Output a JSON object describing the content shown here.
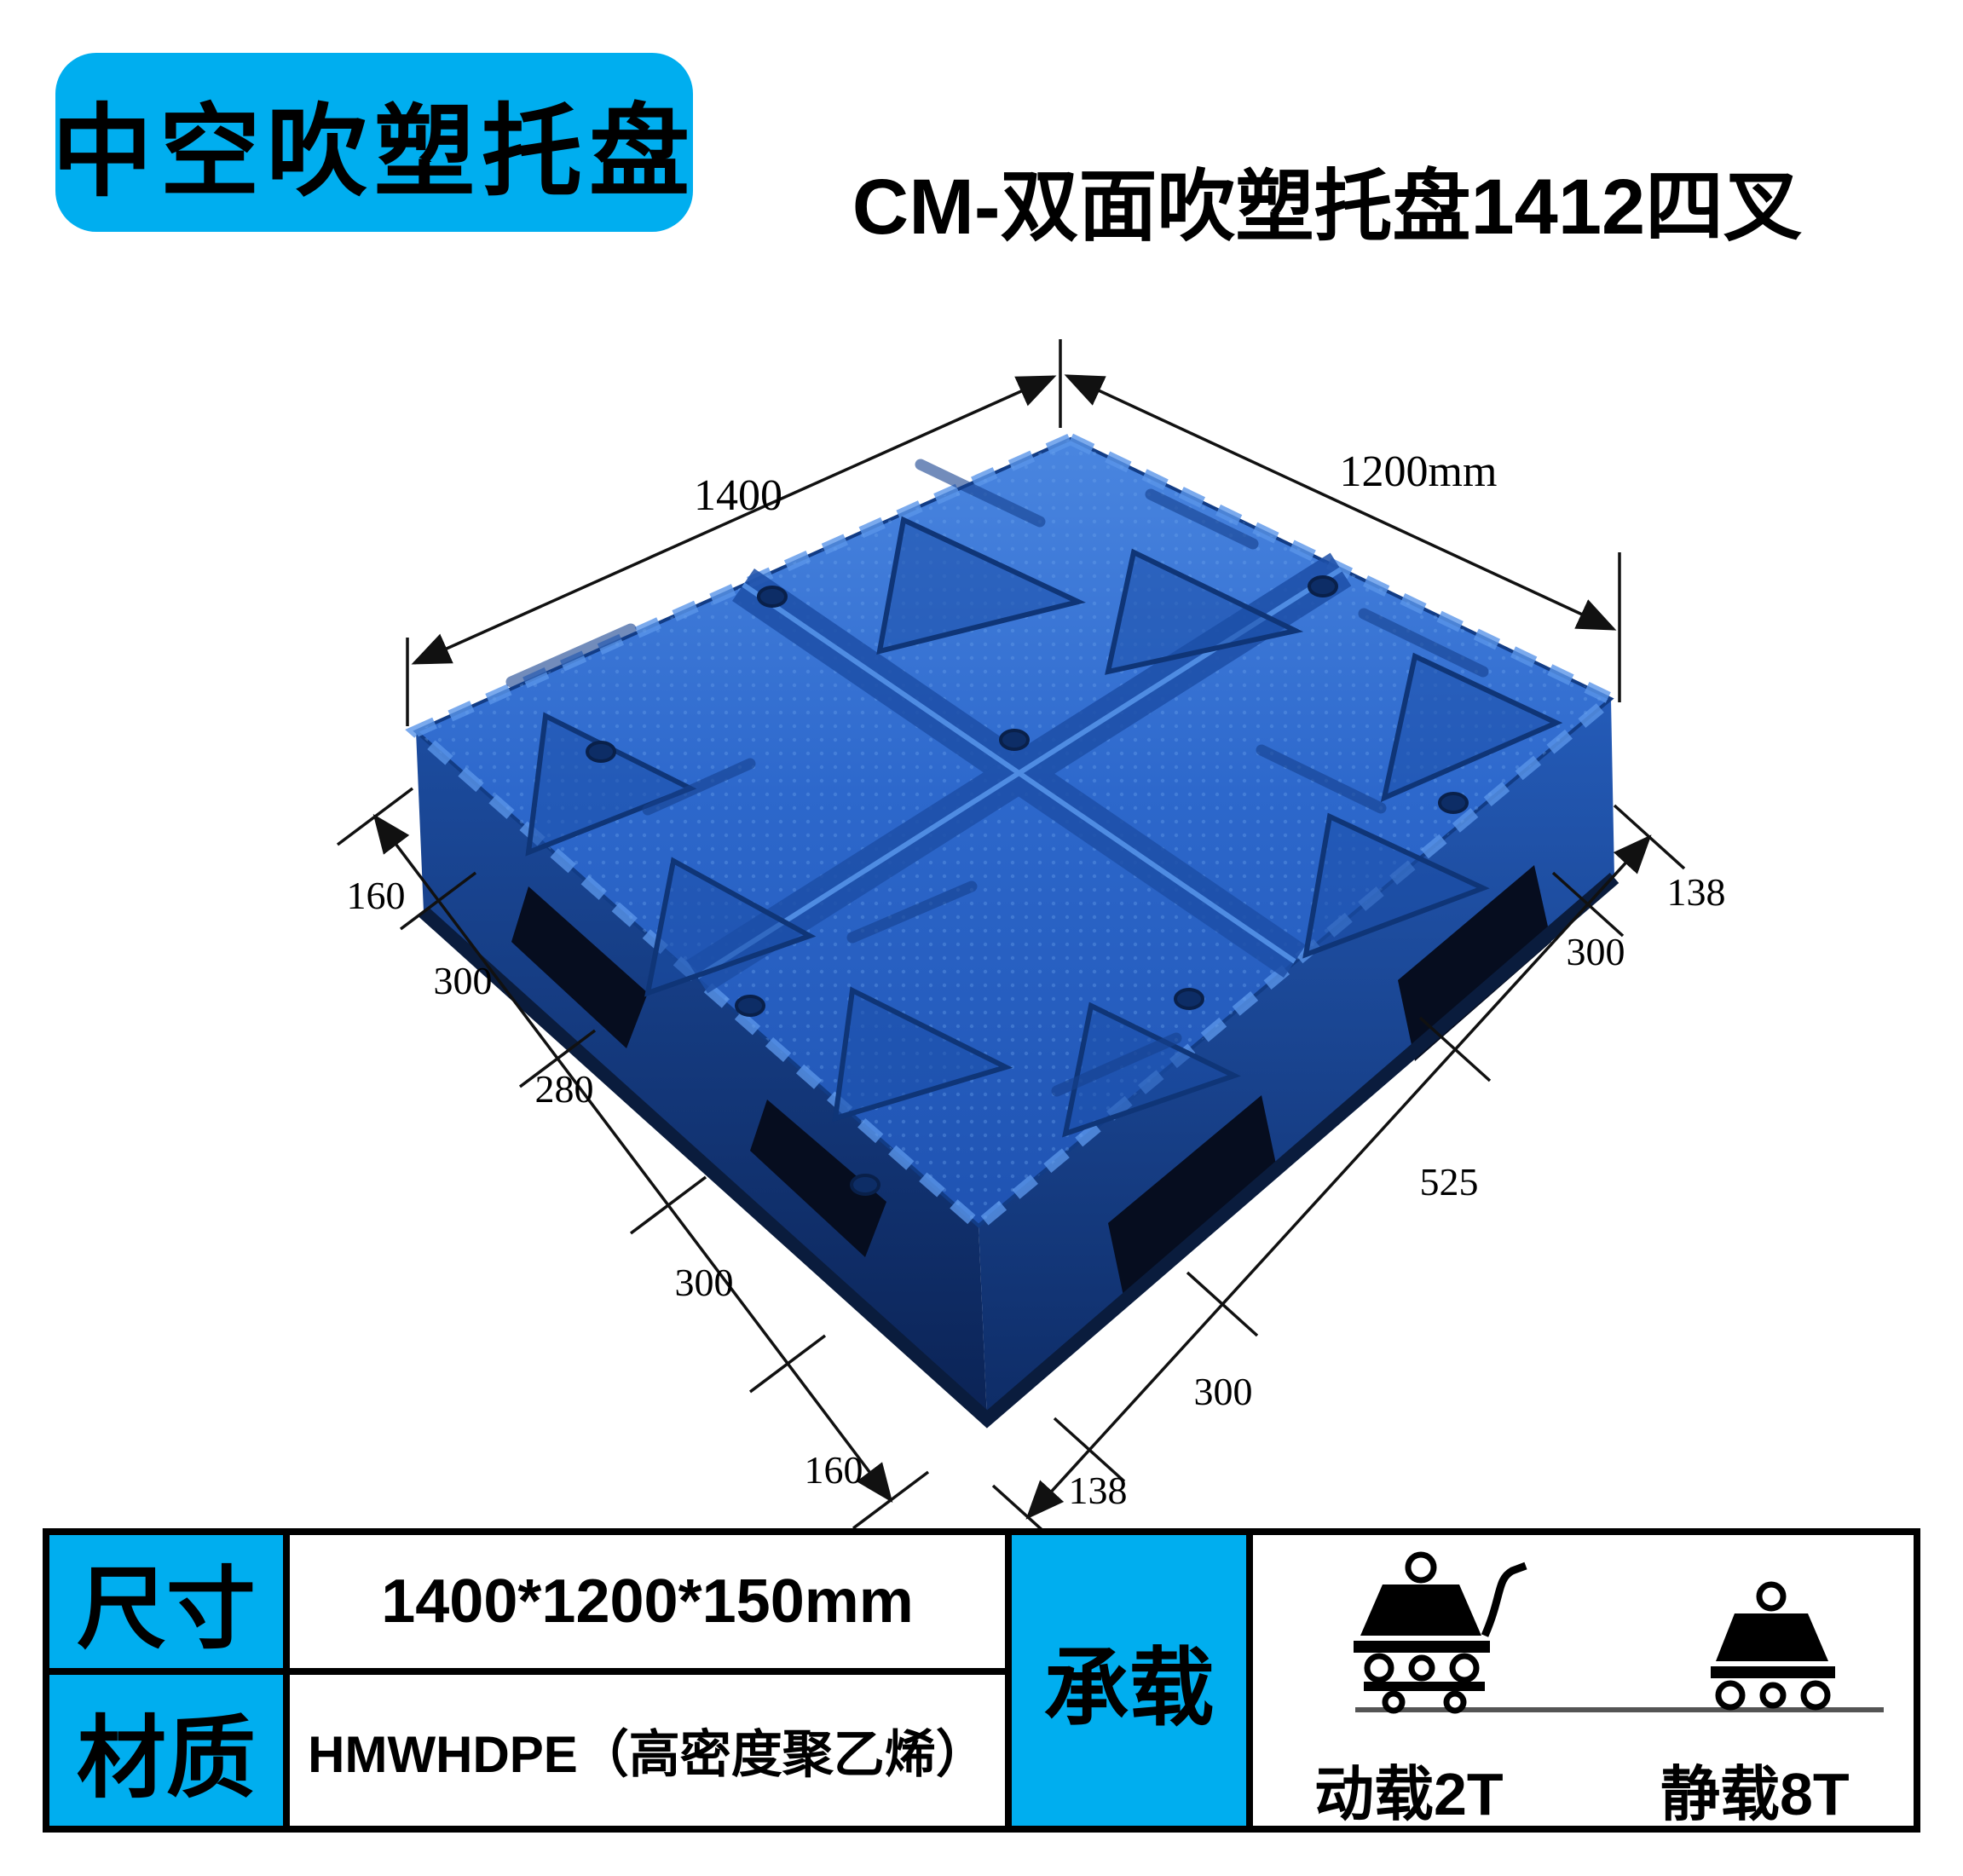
{
  "badge": {
    "label": "中空吹塑托盘"
  },
  "title": {
    "text": "CM-双面吹塑托盘1412四叉"
  },
  "diagram": {
    "length_label": "1400",
    "width_label": "1200mm",
    "left_chain": [
      "160",
      "300",
      "280",
      "300",
      "160"
    ],
    "right_chain": [
      "138",
      "300",
      "525",
      "300",
      "138"
    ]
  },
  "spec_table": {
    "rows": [
      {
        "label": "尺寸",
        "value": "1400*1200*150mm"
      },
      {
        "label": "材质",
        "value": "HMWHDPE（高密度聚乙烯）"
      }
    ],
    "load": {
      "label": "承载",
      "dynamic": "动载2T",
      "static": "静载8T"
    }
  },
  "colors": {
    "accent": "#00AEEF",
    "pallet": "#2B65C9"
  }
}
